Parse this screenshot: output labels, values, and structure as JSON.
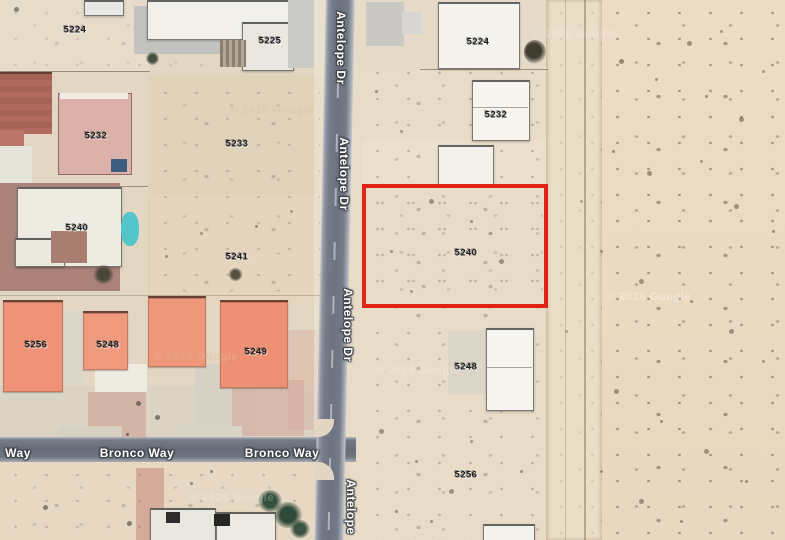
{
  "map": {
    "view": "satellite",
    "parcel_labels": [
      "5224",
      "5225",
      "5232",
      "5233",
      "5240",
      "5241",
      "5256",
      "5248",
      "5249",
      "5224",
      "5232",
      "5240",
      "5248",
      "5256"
    ],
    "street_labels": [
      "Antelope Dr",
      "Antelope Dr",
      "Antelope Dr",
      "Antelope",
      "Way",
      "Bronco Way",
      "Bronco Way"
    ],
    "watermarks": [
      "© 2026 Google",
      "© 2020 Google",
      "© 2026 Google",
      "© 2026 Google",
      "© 2026 Google",
      "© 2020 Google"
    ],
    "highlight": {
      "parcel": "5240",
      "color": "#e02418"
    }
  }
}
